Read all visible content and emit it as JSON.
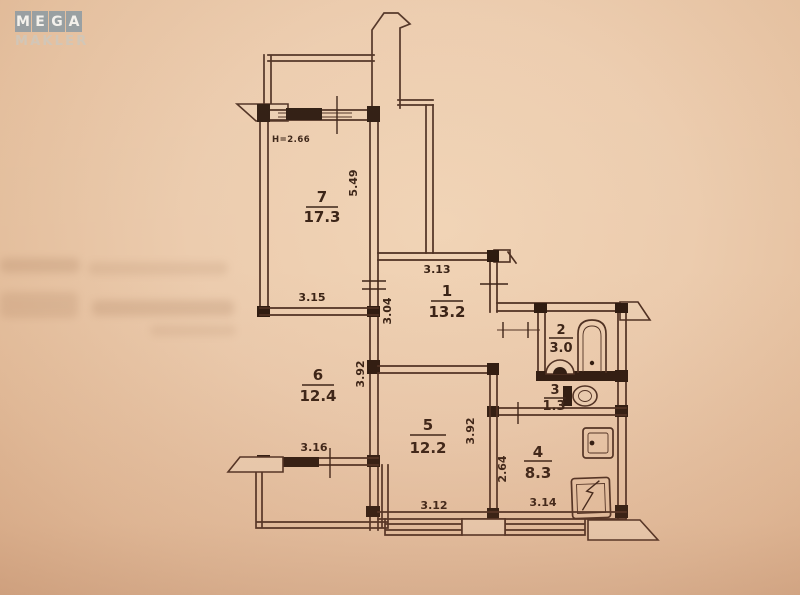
{
  "logo": {
    "top_letters": [
      "M",
      "E",
      "G",
      "A"
    ],
    "bottom_text": "MAKLER",
    "tile_color": "#7d92a0",
    "letter_color": "#f3f1ec"
  },
  "plan": {
    "ceiling_height": "H=2.66",
    "paper_color": "#eccfb2",
    "line_color": "#4e3022",
    "rooms": [
      {
        "number": "7",
        "area": "17.3"
      },
      {
        "number": "1",
        "area": "13.2"
      },
      {
        "number": "6",
        "area": "12.4"
      },
      {
        "number": "5",
        "area": "12.2"
      },
      {
        "number": "2",
        "area": "3.0"
      },
      {
        "number": "3",
        "area": "1.3"
      },
      {
        "number": "4",
        "area": "8.3"
      }
    ],
    "dimensions": {
      "room7_side": "5.49",
      "room7_width": "3.15",
      "room1_width": "3.13",
      "room1_side": "3.04",
      "room6_side": "3.92",
      "room6_width": "3.16",
      "room5_side": "3.92",
      "room5_width": "3.12",
      "kitchen_side": "2.64",
      "kitchen_width": "3.14"
    },
    "fixtures": [
      "bathtub",
      "washbasin",
      "toilet",
      "kitchen-sink",
      "stove"
    ]
  }
}
